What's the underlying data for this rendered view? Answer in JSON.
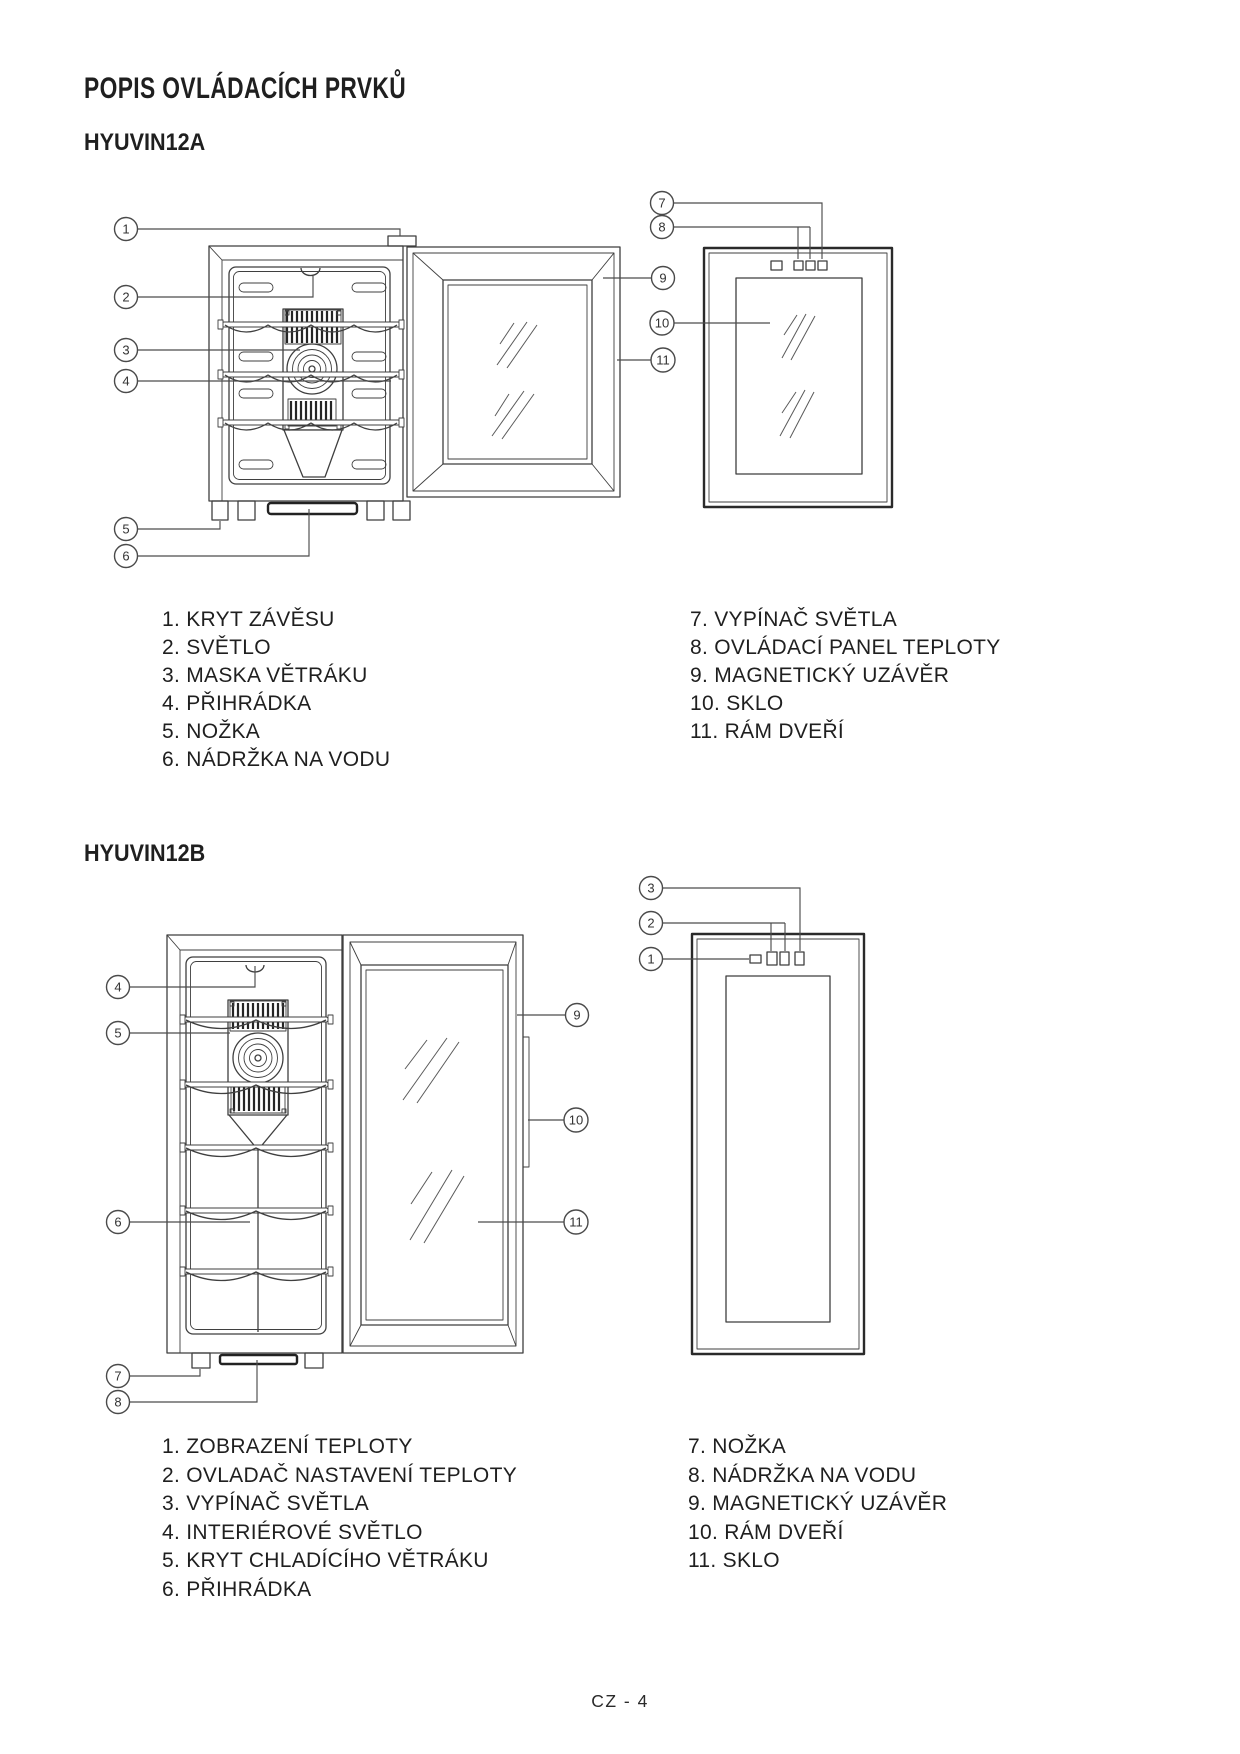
{
  "document": {
    "title": "POPIS OVLÁDACÍCH PRVKŮ",
    "page_number": "CZ - 4"
  },
  "colors": {
    "ink": "#1f1f1f",
    "line": "#3f3f3f"
  },
  "section_a": {
    "heading": "HYUVIN12A",
    "parts_col1": [
      "1. KRYT ZÁVĚSU",
      "2. SVĚTLO",
      "3. MASKA VĚTRÁKU",
      "4. PŘIHRÁDKA",
      "5. NOŽKA",
      "6. NÁDRŽKA NA VODU"
    ],
    "parts_col2": [
      "7. VYPÍNAČ SVĚTLA",
      "8. OVLÁDACÍ PANEL TEPLOTY",
      "9. MAGNETICKÝ UZÁVĚR",
      "10. SKLO",
      "11. RÁM DVEŘÍ"
    ],
    "callouts": [
      "1",
      "2",
      "3",
      "4",
      "5",
      "6",
      "7",
      "8",
      "9",
      "10",
      "11"
    ]
  },
  "section_b": {
    "heading": "HYUVIN12B",
    "parts_col1": [
      "1. ZOBRAZENÍ TEPLOTY",
      "2. OVLADAČ NASTAVENÍ TEPLOTY",
      "3. VYPÍNAČ SVĚTLA",
      "4. INTERIÉROVÉ SVĚTLO",
      "5. KRYT CHLADÍCÍHO VĚTRÁKU",
      "6. PŘIHRÁDKA"
    ],
    "parts_col2": [
      "7. NOŽKA",
      "8. NÁDRŽKA NA VODU",
      "9. MAGNETICKÝ UZÁVĚR",
      "10. RÁM DVEŘÍ",
      "11. SKLO"
    ],
    "callouts": [
      "1",
      "2",
      "3",
      "4",
      "5",
      "6",
      "7",
      "8",
      "9",
      "10",
      "11"
    ]
  }
}
